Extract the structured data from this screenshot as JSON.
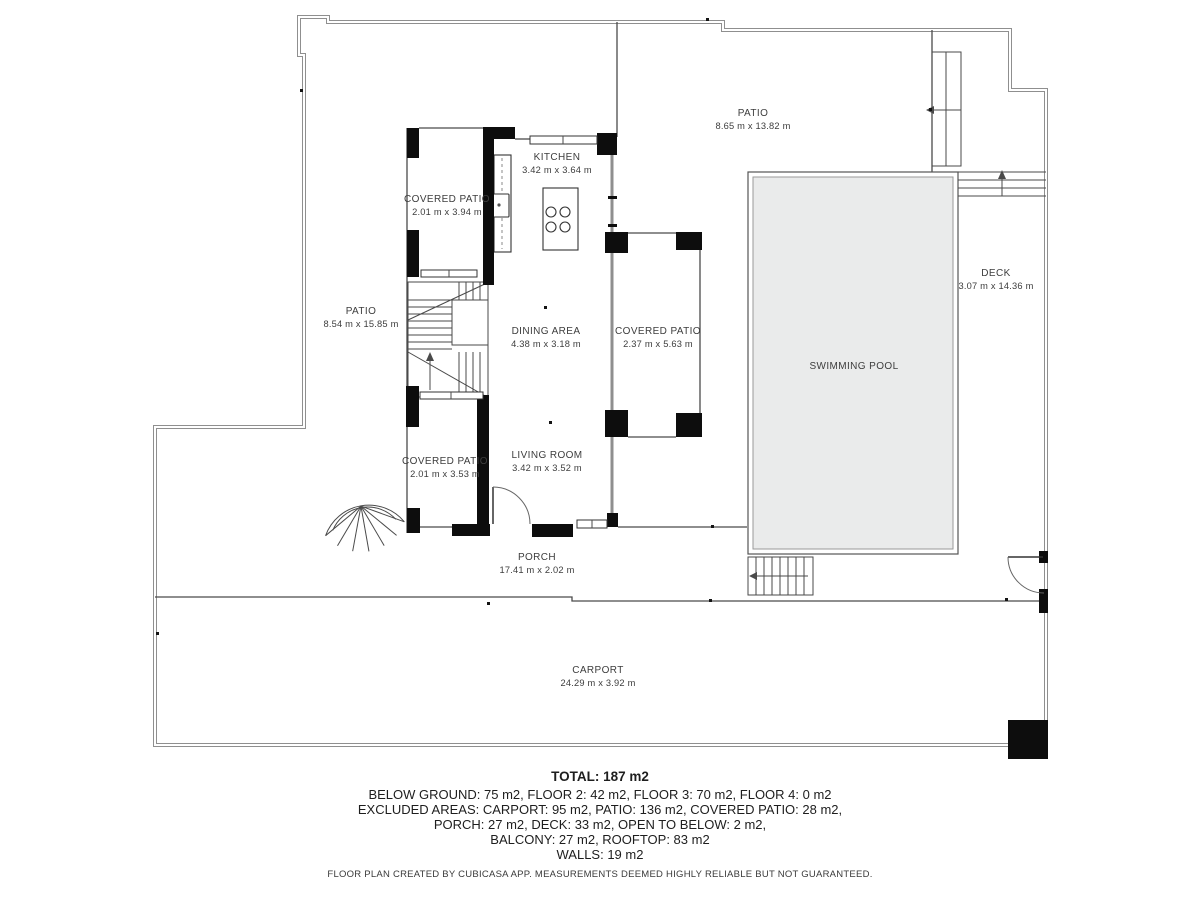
{
  "plan": {
    "rooms": {
      "patio_top": {
        "name": "PATIO",
        "dims": "8.65 m x 13.82 m"
      },
      "patio_left": {
        "name": "PATIO",
        "dims": "8.54 m x 15.85 m"
      },
      "kitchen": {
        "name": "KITCHEN",
        "dims": "3.42 m x 3.64 m"
      },
      "covered_patio_top": {
        "name": "COVERED PATIO",
        "dims": "2.01 m x 3.94 m"
      },
      "dining_area": {
        "name": "DINING AREA",
        "dims": "4.38 m x 3.18 m"
      },
      "covered_patio_right": {
        "name": "COVERED PATIO",
        "dims": "2.37 m x 5.63 m"
      },
      "swimming_pool": {
        "name": "SWIMMING POOL"
      },
      "deck": {
        "name": "DECK",
        "dims": "3.07 m x 14.36 m"
      },
      "living_room": {
        "name": "LIVING ROOM",
        "dims": "3.42 m x 3.52 m"
      },
      "covered_patio_bottom": {
        "name": "COVERED PATIO",
        "dims": "2.01 m x 3.53 m"
      },
      "porch": {
        "name": "PORCH",
        "dims": "17.41 m x 2.02 m"
      },
      "carport": {
        "name": "CARPORT",
        "dims": "24.29 m x 3.92 m"
      }
    },
    "summary": {
      "total": "TOTAL: 187 m2",
      "line1": "BELOW GROUND: 75 m2, FLOOR 2: 42 m2, FLOOR 3: 70 m2, FLOOR 4: 0 m2",
      "line2": "EXCLUDED AREAS: CARPORT: 95 m2, PATIO: 136 m2, COVERED PATIO: 28 m2,",
      "line3": "PORCH: 27 m2, DECK: 33 m2, OPEN TO BELOW: 2 m2,",
      "line4": "BALCONY: 27 m2, ROOFTOP: 83 m2",
      "line5": "WALLS: 19 m2"
    },
    "footer": "FLOOR PLAN CREATED BY CUBICASA APP. MEASUREMENTS DEEMED HIGHLY RELIABLE BUT NOT GUARANTEED.",
    "colors": {
      "wall": "#0d0d0d",
      "boundary": "#8f8f8f",
      "pool_fill": "#eaebeb",
      "text": "#3d3d3d"
    }
  }
}
